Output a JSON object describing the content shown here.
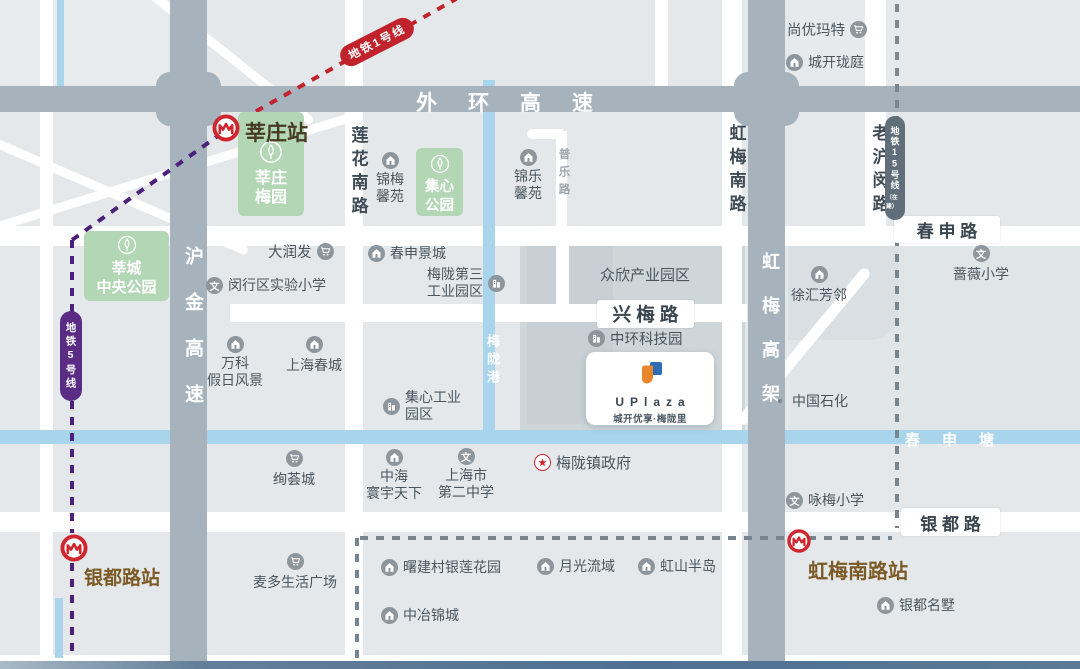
{
  "map": {
    "expressways": [
      {
        "id": "waihuan",
        "label": "外环高速"
      },
      {
        "id": "hujin",
        "label": "沪金高速"
      },
      {
        "id": "hongmei-gaojia",
        "label": "虹梅高架"
      }
    ],
    "roads": [
      {
        "id": "lianhua",
        "label": "莲花南路"
      },
      {
        "id": "hongmeinan",
        "label": "虹梅南路"
      },
      {
        "id": "laohumin",
        "label": "老沪闵路"
      },
      {
        "id": "pule",
        "label": "普乐路"
      },
      {
        "id": "chunshen",
        "label": "春 申 路"
      },
      {
        "id": "xingmei",
        "label": "兴 梅 路"
      },
      {
        "id": "yindu",
        "label": "银 都 路"
      }
    ],
    "rivers": [
      {
        "id": "chunshentang",
        "label": "春申塘"
      },
      {
        "id": "meilonggang",
        "label": "梅陇港"
      }
    ],
    "metro_lines": [
      {
        "id": "line1",
        "label": "地铁1号线",
        "color": "#c0232c"
      },
      {
        "id": "line5",
        "label": "地铁5号线",
        "color": "#4b2179",
        "capsule_color": "#5b2c84"
      },
      {
        "id": "line15",
        "label": "地铁15号线",
        "sub": "（在建）",
        "color": "#78858f",
        "capsule_color": "#606e79"
      }
    ],
    "stations": [
      {
        "id": "xinzhuang",
        "label": "莘庄站",
        "color": "#463b21"
      },
      {
        "id": "yindulu",
        "label": "银都路站",
        "color": "#7b5a25"
      },
      {
        "id": "hongmeinanlu",
        "label": "虹梅南路站",
        "color": "#7b5a25"
      }
    ],
    "parks": [
      {
        "id": "xinzhuang-meiyuan",
        "lines": [
          "莘庄",
          "梅园"
        ]
      },
      {
        "id": "jixin-gongyuan",
        "lines": [
          "集心",
          "公园"
        ]
      },
      {
        "id": "xincheng-zhongyang",
        "lines": [
          "莘城",
          "中央公园"
        ]
      }
    ],
    "pois": [
      {
        "id": "shangyoumate",
        "icon": "cart",
        "label": "尚优玛特"
      },
      {
        "id": "chengkai-longting",
        "icon": "home",
        "label": "城开珑庭"
      },
      {
        "id": "jinmei-xinyuan",
        "icon": "home",
        "lines": [
          "锦梅",
          "馨苑"
        ]
      },
      {
        "id": "jinle-xinyuan",
        "icon": "home",
        "lines": [
          "锦乐",
          "馨苑"
        ]
      },
      {
        "id": "darunfa",
        "icon": "cart",
        "label": "大润发"
      },
      {
        "id": "minhang-shiyan-xiaoxue",
        "icon": "school",
        "label": "闵行区实验小学"
      },
      {
        "id": "chunshen-jingcheng",
        "icon": "home",
        "label": "春申景城"
      },
      {
        "id": "meilong-disan",
        "icon": "industry",
        "lines": [
          "梅陇第三",
          "工业园区"
        ]
      },
      {
        "id": "zhongxin",
        "icon": "none",
        "label": "众欣产业园区"
      },
      {
        "id": "wanke",
        "icon": "home",
        "lines": [
          "万科",
          "假日风景"
        ]
      },
      {
        "id": "shanghai-chuncheng",
        "icon": "home",
        "label": "上海春城"
      },
      {
        "id": "jixin-gongye",
        "icon": "industry",
        "lines": [
          "集心工业",
          "园区"
        ]
      },
      {
        "id": "zhonghuan-keji",
        "icon": "industry",
        "label": "中环科技园"
      },
      {
        "id": "zhongguo-shihua",
        "icon": "dot",
        "label": "中国石化"
      },
      {
        "id": "xuhui-fanglin",
        "icon": "home",
        "label": "徐汇芳邻"
      },
      {
        "id": "qiangwei-xiaoxue",
        "icon": "school",
        "label": "蔷薇小学"
      },
      {
        "id": "xuanhui-cheng",
        "icon": "cart",
        "label": "绚荟城"
      },
      {
        "id": "maiduo",
        "icon": "cart",
        "label": "麦多生活广场"
      },
      {
        "id": "zhonghai",
        "icon": "home",
        "lines": [
          "中海",
          "寰宇天下"
        ]
      },
      {
        "id": "shanghai-dier",
        "icon": "school",
        "lines": [
          "上海市",
          "第二中学"
        ]
      },
      {
        "id": "meilong-zhengfu",
        "icon": "gov",
        "label": "梅陇镇政府"
      },
      {
        "id": "yongmei-xiaoxue",
        "icon": "school",
        "label": "咏梅小学"
      },
      {
        "id": "yindu-mingshu",
        "icon": "home",
        "label": "银都名墅"
      },
      {
        "id": "shujiancun",
        "icon": "home",
        "label": "曙建村银莲花园"
      },
      {
        "id": "yueguang",
        "icon": "home",
        "label": "月光流域"
      },
      {
        "id": "hongshan",
        "icon": "home",
        "label": "虹山半岛"
      },
      {
        "id": "zhongye",
        "icon": "home",
        "label": "中冶锦城"
      }
    ],
    "project": {
      "letters": "UPlaza",
      "tagline": "城开优享·梅陇里"
    },
    "colors": {
      "road_gray": "#a6b3bc",
      "river_blue": "#a8d4ec",
      "park_green": "#b3d6b5",
      "metro_red": "#cf2630"
    }
  }
}
